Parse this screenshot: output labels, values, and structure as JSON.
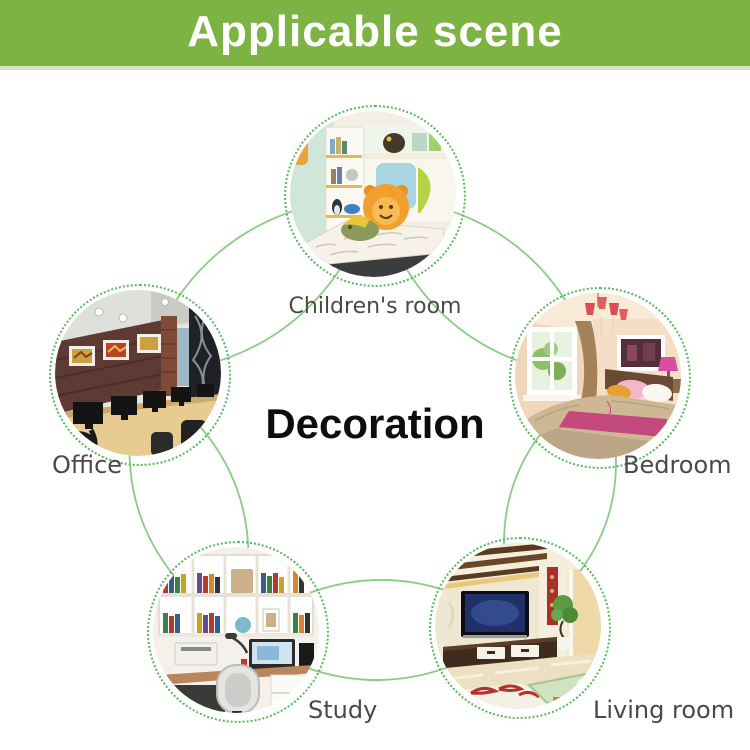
{
  "banner": {
    "title": "Applicable scene"
  },
  "center": {
    "label": "Decoration"
  },
  "scenes": [
    {
      "label": "Children's room"
    },
    {
      "label": "Bedroom"
    },
    {
      "label": "Living room"
    },
    {
      "label": "Study"
    },
    {
      "label": "Office"
    }
  ],
  "colors": {
    "banner_green": "#7cb342",
    "connector_green": "#8bcd86",
    "ring_green": "#56bb58",
    "label_gray": "#4a4a45",
    "center_text": "#0d0d0d"
  }
}
